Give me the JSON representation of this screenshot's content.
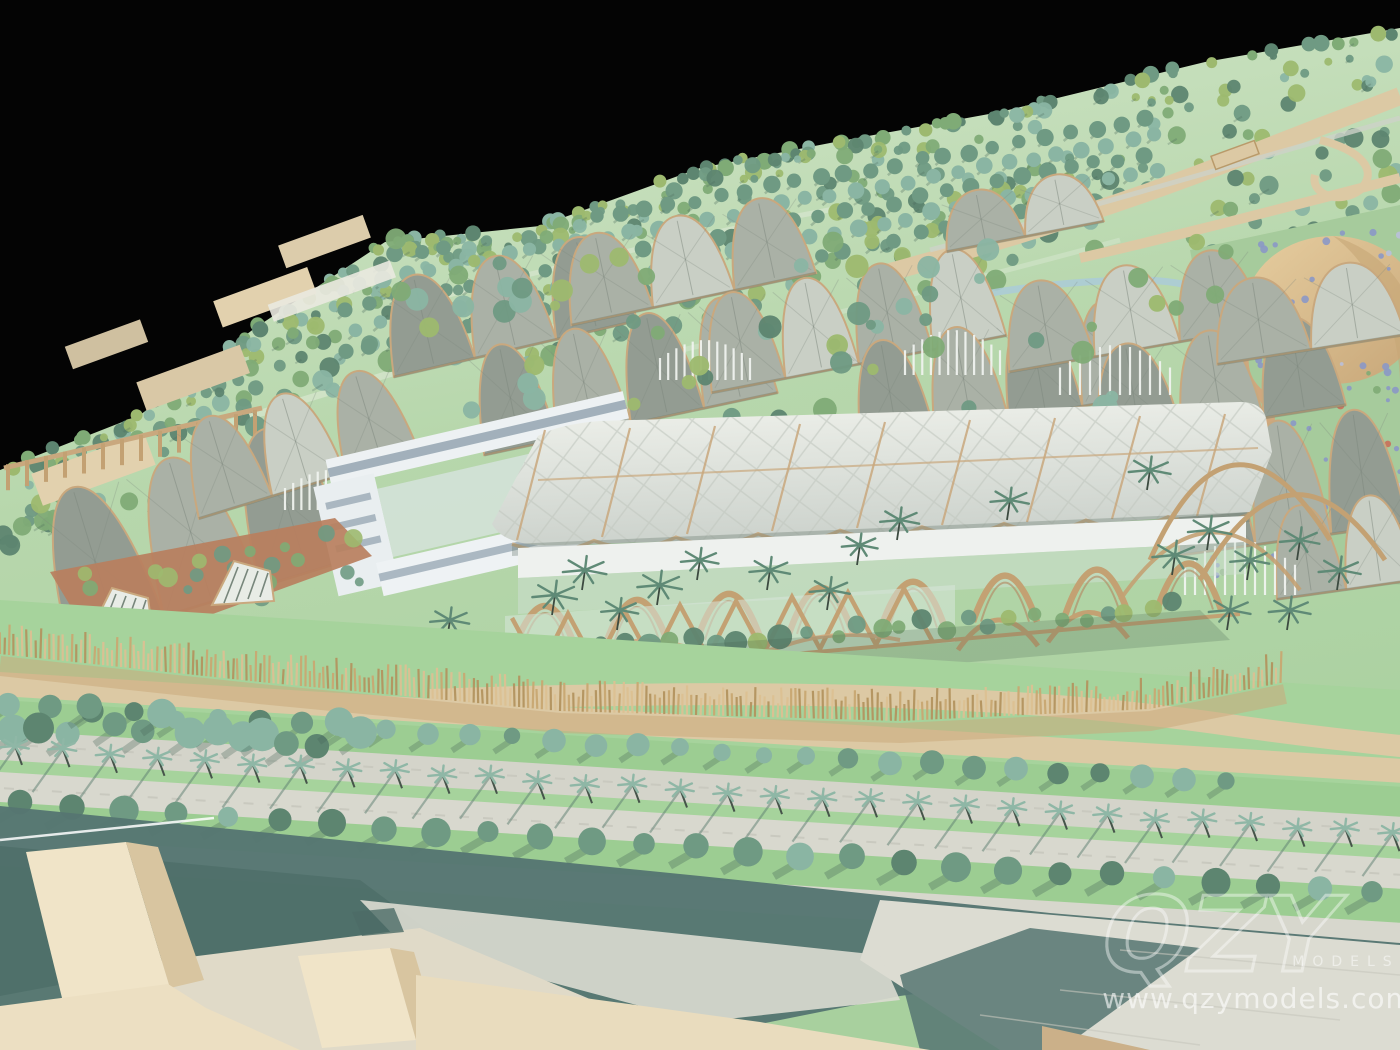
{
  "meta": {
    "description": "Photograph of a physical architectural scale model: a terraced green park with translucent vaulted canopy pavilions, timber arches, palm-lined boulevard, shadow band and cream massing blocks in the foreground, on a black studio backdrop."
  },
  "watermark": {
    "logo": "QZY",
    "wordmark": "MODELS",
    "url": "www.qzymodels.com"
  },
  "palette": {
    "bg": "#040404",
    "hill-1": "#cfe3c5",
    "hill-2": "#aacfa1",
    "grass": "#a6d39c",
    "grass-2": "#9ccd92",
    "lawn": "#b5d8aa",
    "road-tan": "#dcc9a4",
    "road-grey": "#d4d4ca",
    "road-grey2": "#d8d8ce",
    "sidewalk": "#d7d7cd",
    "rib-tan": "#c9a87e",
    "timber": "#c3a173",
    "bamboo": "#dcc193",
    "bamboo-dark": "#b3945f",
    "brick": "#b97f5e",
    "canopy": "#aab1a6",
    "canopy-dark": "#939c92",
    "canopy-light": "#c9cfc5",
    "roof-white": "#e9ece6",
    "white-bldg": "#edf1f3",
    "window": "#8fa0ac",
    "plaza": "#dcdcd2",
    "cream": "#f0e4c8",
    "cream-mid": "#e9dcbe",
    "cream-side": "#d8c5a0",
    "teal": "#567672",
    "teal-deep": "#4c6c67",
    "tree-1": "#6f9a83",
    "tree-2": "#8ab5a3",
    "tree-3": "#5d8570",
    "tree-4": "#7fab76",
    "tree-5": "#9db96f",
    "tree-dark": "#48675a",
    "palm": "#8fb7a6",
    "palm-dark": "#5f8a76",
    "meadow": "#a6cb9c",
    "sand": "#dcc093",
    "sand-dark": "#c6a777",
    "flower": "#8b98c6",
    "flower-2": "#b9c0da",
    "flower-red": "#c96f5a",
    "water": "#aacbd8",
    "white": "#ffffff"
  },
  "scene": {
    "background": "black studio backdrop",
    "regions": [
      "forested hillside",
      "orchard tree rows",
      "winding tan roads",
      "stream",
      "low tan hillside buildings with colonnade",
      "wildflower meadow with sand dome",
      "grey pillow-vault canopies",
      "white courtyard building",
      "brick conservatory with arched lattice windows",
      "main timber-arch pavilion with fabric roof",
      "white trellis screens",
      "serpentine timber wall",
      "bamboo stick fence",
      "hedge rows",
      "palm-lined boulevard",
      "street tree rows",
      "teal shadow band over canal and paving",
      "cream massing blocks on plaza"
    ],
    "generate": {
      "seed": 42,
      "hillTrees": 380,
      "edgeTrees": 90,
      "orchardRows": 5,
      "orchardPerRow": 33,
      "boulevardPalms": 30,
      "shrubRowA": 30,
      "shrubRowB": 27,
      "leftGroveTrees": 15,
      "flowers": 130,
      "hedgeBlobs": 32,
      "bermBlobs": 26,
      "canopyTopBlobs": 46,
      "fenceStep": 4.5
    }
  }
}
